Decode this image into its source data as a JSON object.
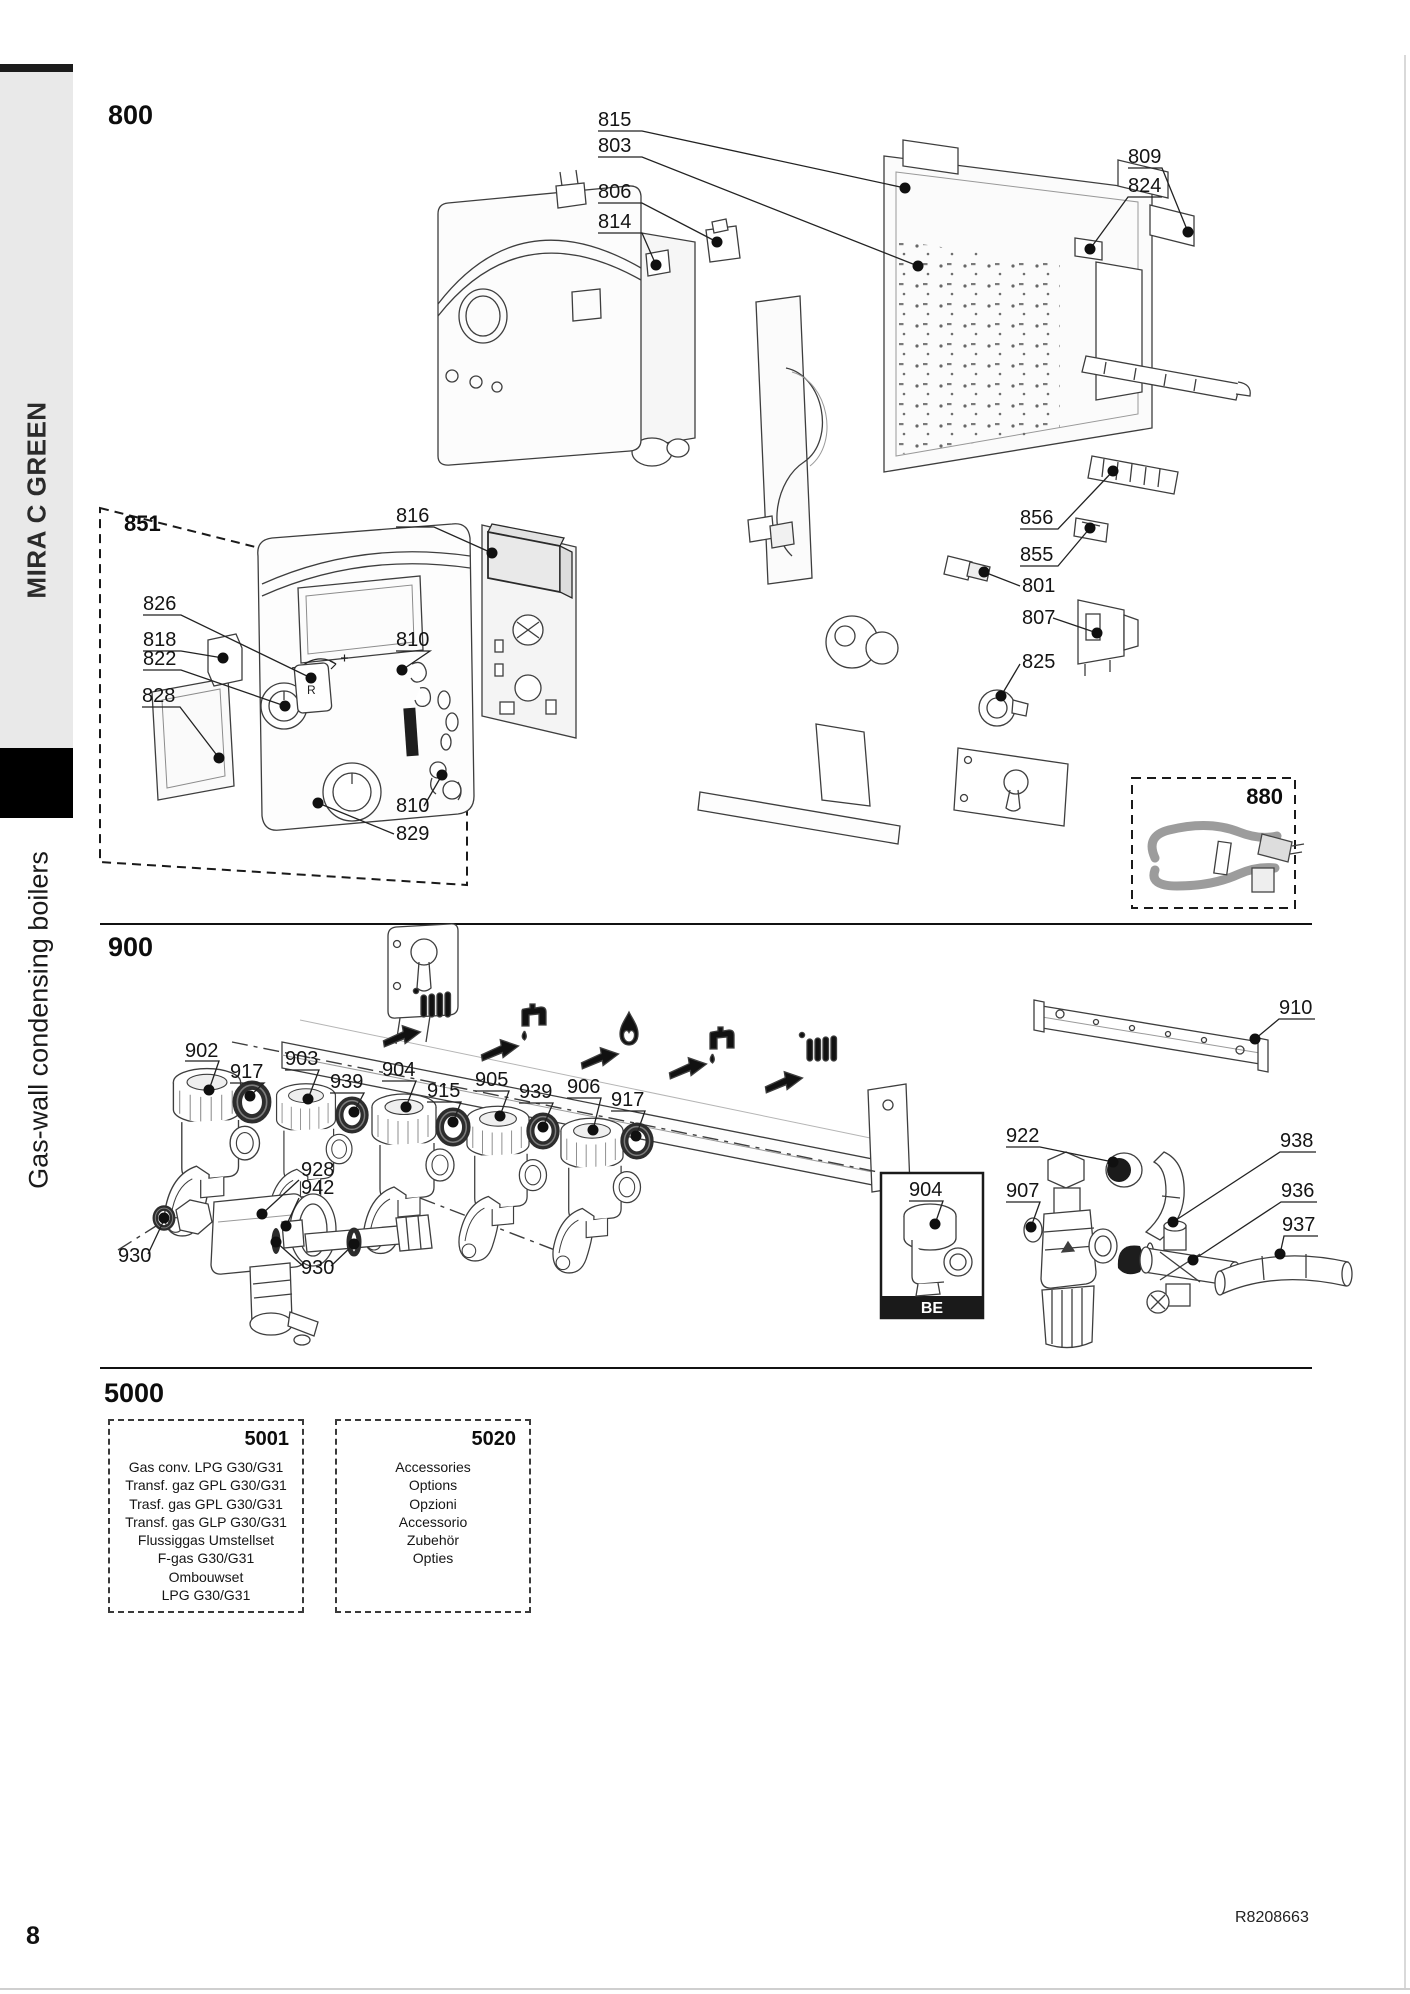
{
  "page": {
    "page_number": "8",
    "doc_ref": "R8208663"
  },
  "sidebar": {
    "brand": "MIRA C GREEN",
    "product_line": "Gas-wall condensing boilers"
  },
  "sections": {
    "s800": {
      "title": "800",
      "group851": "851",
      "group880": "880",
      "fascia_button": "R",
      "labels": {
        "l815": "815",
        "l803": "803",
        "l806": "806",
        "l814": "814",
        "l809": "809",
        "l824": "824",
        "l856": "856",
        "l855": "855",
        "l801": "801",
        "l807": "807",
        "l825": "825",
        "l816": "816",
        "l826": "826",
        "l818": "818",
        "l822": "822",
        "l828": "828",
        "l810a": "810",
        "l810b": "810",
        "l829": "829"
      }
    },
    "s900": {
      "title": "900",
      "be_badge": "BE",
      "labels": {
        "l902": "902",
        "l917a": "917",
        "l903": "903",
        "l939a": "939",
        "l904": "904",
        "l915": "915",
        "l905": "905",
        "l939b": "939",
        "l906": "906",
        "l917b": "917",
        "l928": "928",
        "l942": "942",
        "l930a": "930",
        "l930b": "930",
        "l910": "910",
        "l922": "922",
        "l938": "938",
        "l907": "907",
        "l936": "936",
        "l937": "937",
        "l904be": "904"
      }
    },
    "s5000": {
      "title": "5000",
      "box5001": {
        "code": "5001",
        "lines": [
          "Gas conv. LPG G30/G31",
          "Transf. gaz GPL G30/G31",
          "Trasf. gas GPL G30/G31",
          "Transf. gas GLP G30/G31",
          "Flussiggas Umstellset",
          "F-gas G30/G31",
          "Ombouwset",
          "LPG G30/G31"
        ]
      },
      "box5020": {
        "code": "5020",
        "lines": [
          "Accessories",
          "Options",
          "Opzioni",
          "Accessorio",
          "Zubehör",
          "Opties"
        ]
      }
    }
  }
}
